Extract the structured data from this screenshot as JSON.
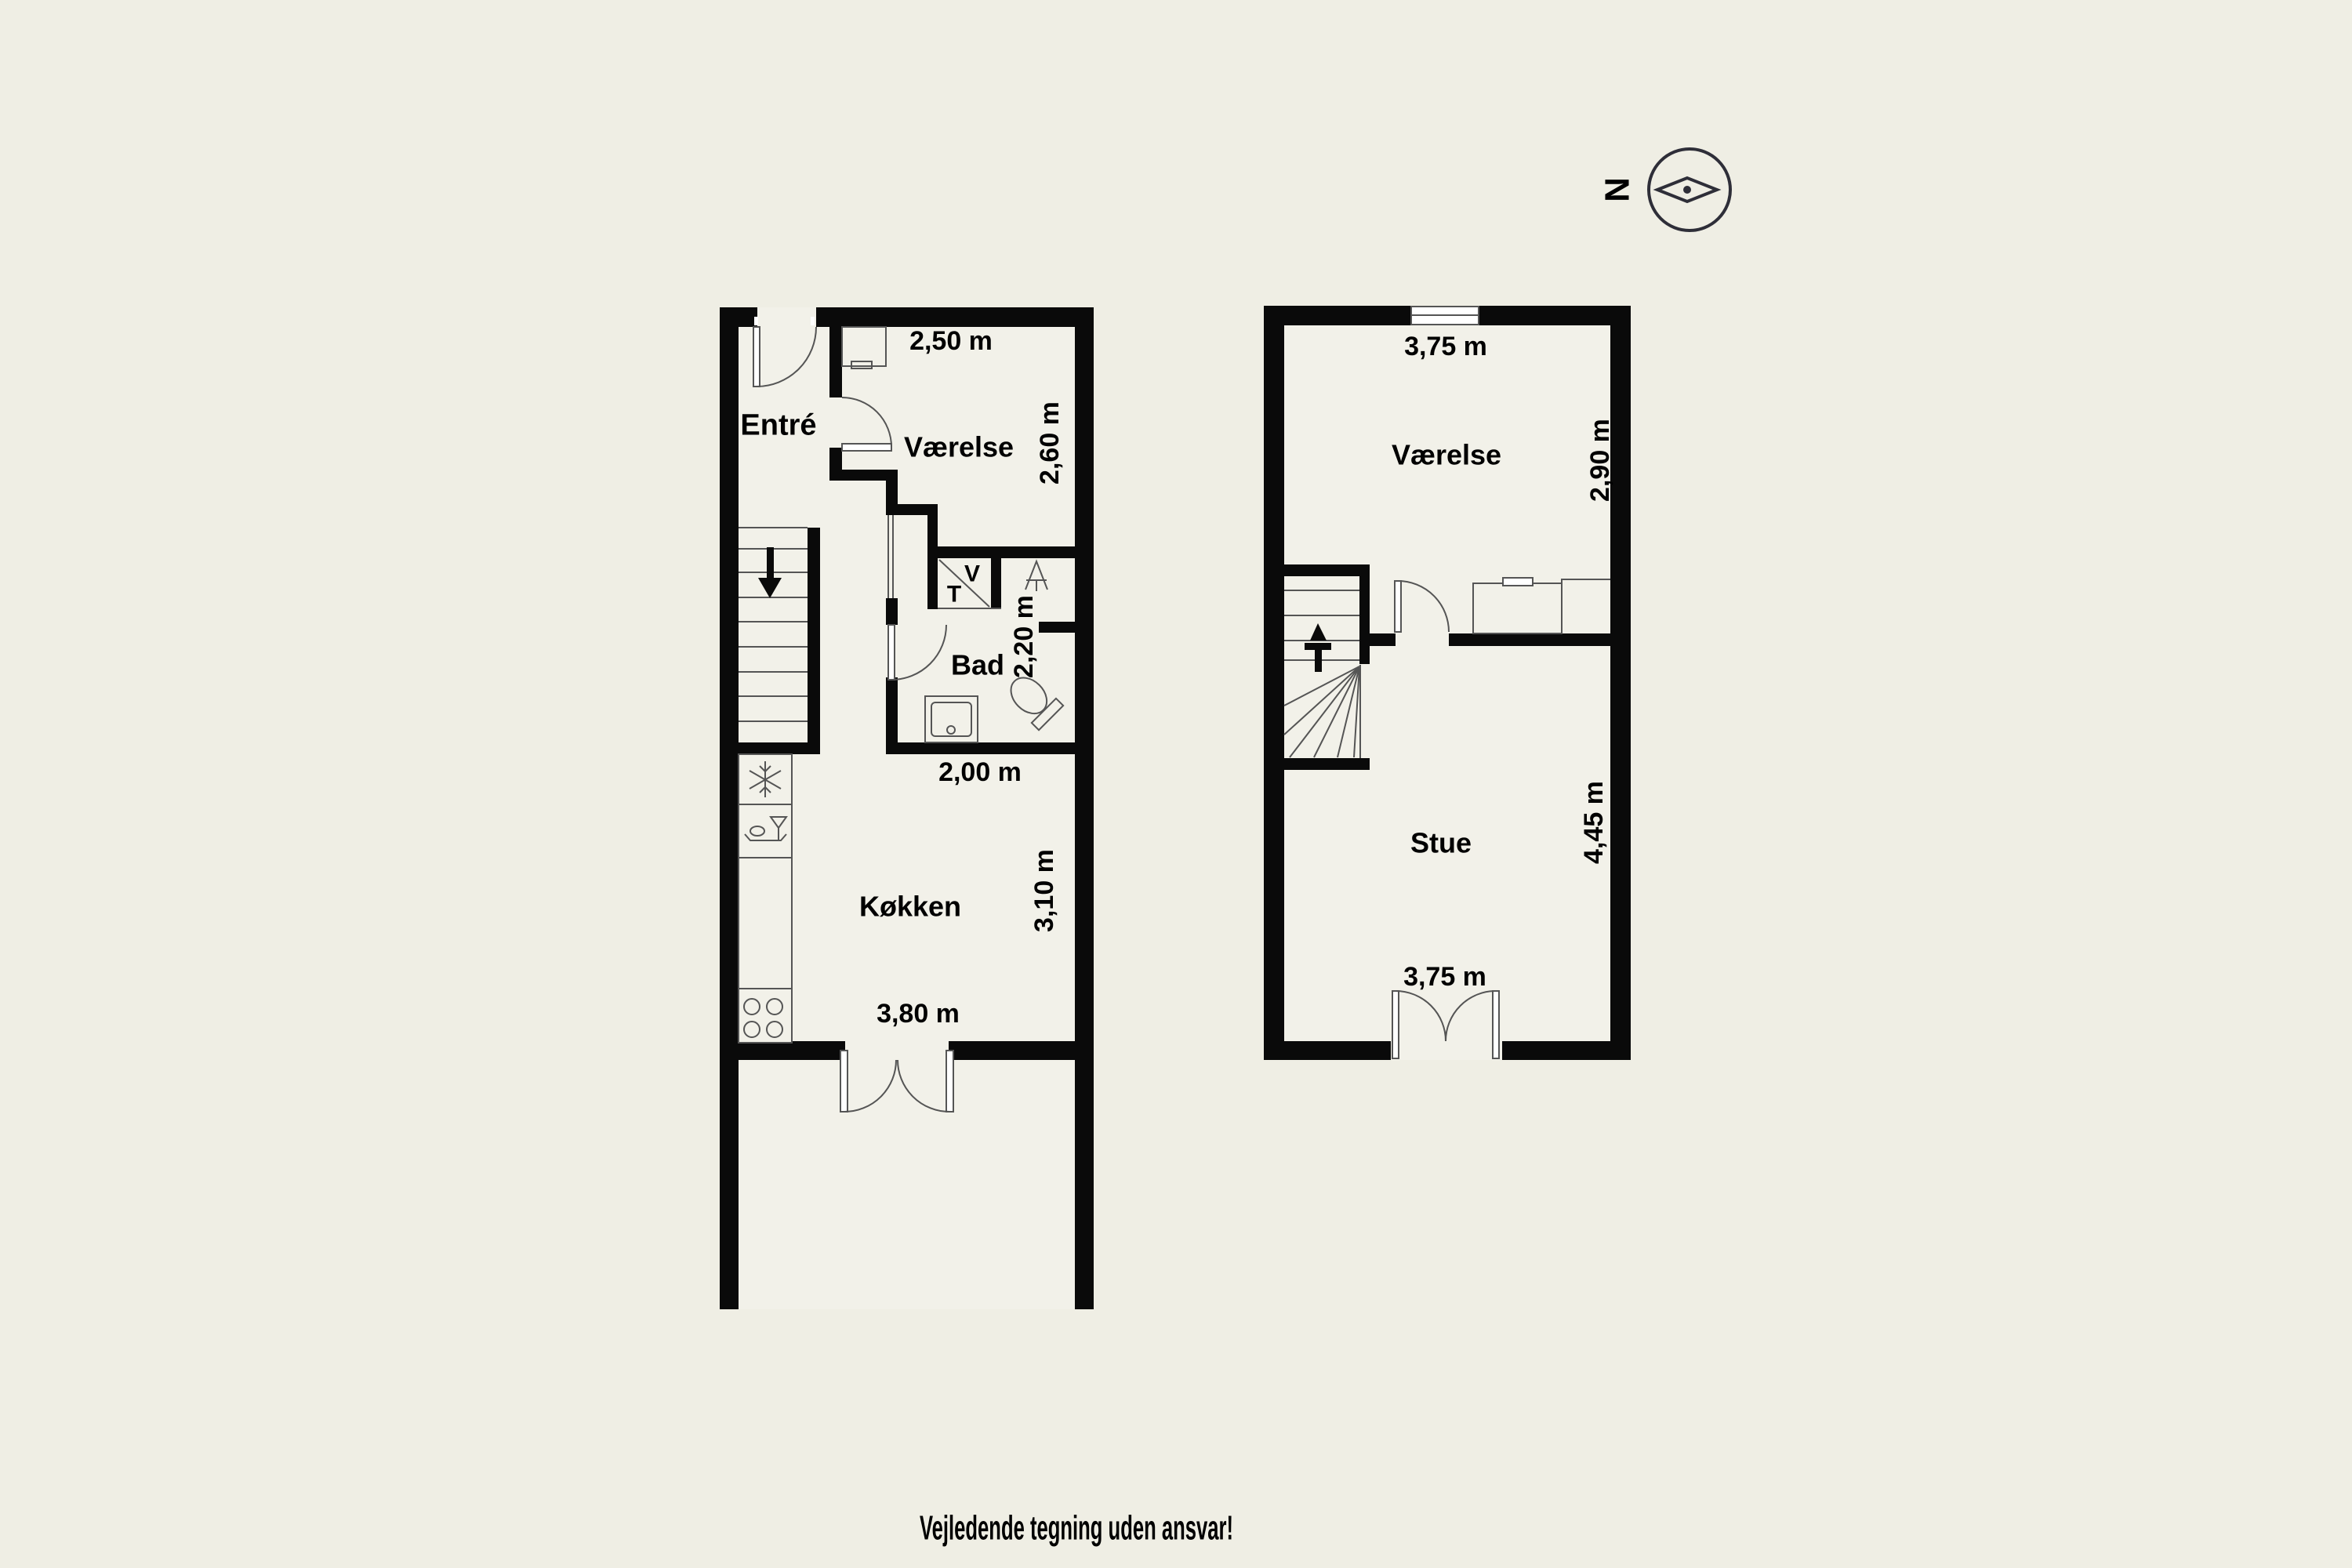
{
  "page": {
    "background_color": "#efeee4",
    "wall_color": "#0a0a0a",
    "line_color": "#555555",
    "room_fill_color": "#f2f1e9",
    "disclaimer": "Vejledende tegning uden ansvar!"
  },
  "compass": {
    "north_label": "N"
  },
  "ground_floor": {
    "rooms": {
      "entre": {
        "label": "Entré"
      },
      "vaerelse": {
        "label": "Værelse",
        "width": "2,50 m",
        "depth": "2,60 m"
      },
      "bad": {
        "label": "Bad",
        "width": "2,00 m",
        "depth": "2,20 m"
      },
      "koekken": {
        "label": "Køkken",
        "width": "3,80 m",
        "depth": "3,10 m"
      }
    },
    "utility_closet": {
      "washer_label": "V",
      "dryer_label": "T"
    }
  },
  "first_floor": {
    "rooms": {
      "vaerelse": {
        "label": "Værelse",
        "width": "3,75 m",
        "depth": "2,90 m"
      },
      "stue": {
        "label": "Stue",
        "width": "3,75 m",
        "depth": "4,45 m"
      }
    }
  },
  "icons": {
    "compass": "compass-icon",
    "stairs_down": "arrow-down-icon",
    "stairs_up": "arrow-up-icon",
    "freezer": "snowflake-icon",
    "dishwasher": "dishwasher-icon",
    "stove": "burners-icon",
    "shower": "shower-icon"
  }
}
